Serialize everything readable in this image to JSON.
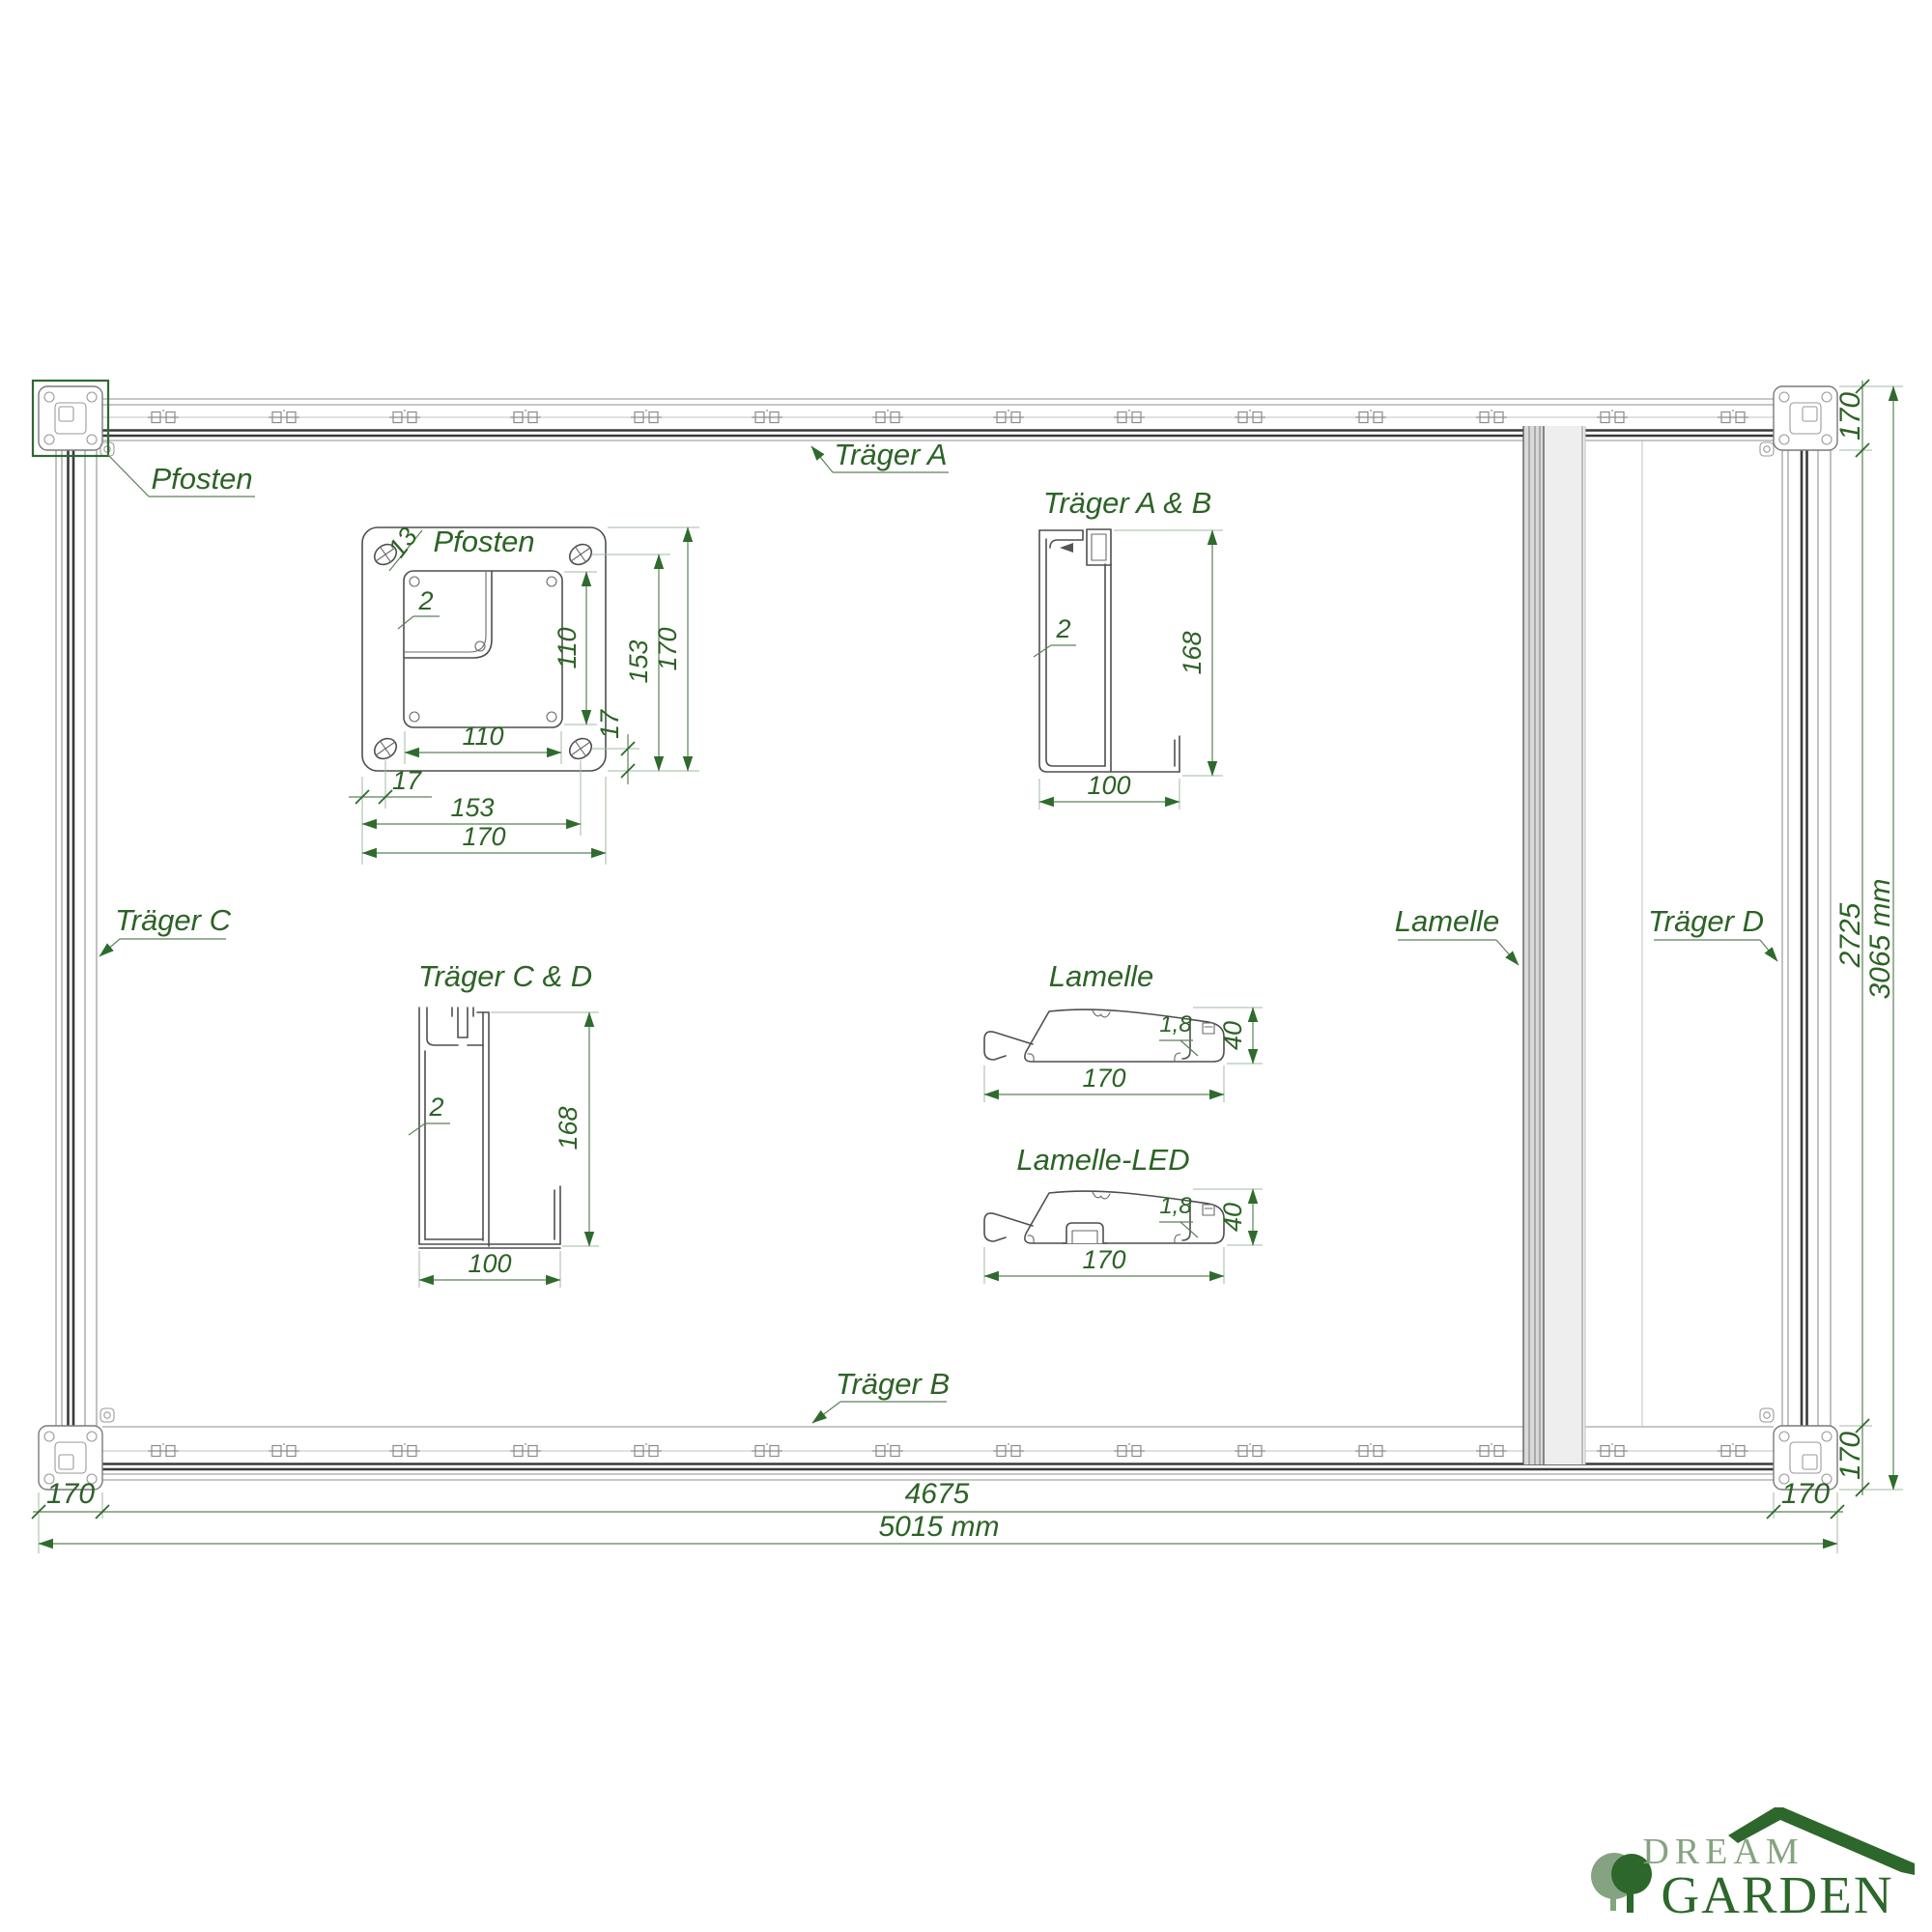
{
  "colors": {
    "dim_green": "#2c6325",
    "accent_green": "#2e6b2c",
    "logo_light_green": "#86a381",
    "logo_dark_green": "#2d672b",
    "line_gray": "#8f8f8f",
    "dark_line": "#3a3a3a"
  },
  "plan": {
    "labels": {
      "pfosten": "Pfosten",
      "traeger_a": "Träger A",
      "traeger_b": "Träger B",
      "traeger_c": "Träger C",
      "traeger_d": "Träger D",
      "lamelle": "Lamelle"
    },
    "dims": {
      "right_top_170": "170",
      "right_inner": "2725",
      "right_bottom_170": "170",
      "right_total": "3065 mm",
      "bottom_left_170": "170",
      "bottom_inner": "4675",
      "bottom_right_170": "170",
      "bottom_total": "5015 mm"
    }
  },
  "details": {
    "pfosten": {
      "title": "Pfosten",
      "hole_dia": "13",
      "wall": "2",
      "inner_height": "110",
      "bolt_offset_v": "153",
      "plate_height": "170",
      "edge_v": "17",
      "inner_width": "110",
      "edge_h": "17",
      "bolt_offset_h": "153",
      "plate_width": "170"
    },
    "traeger_ab": {
      "title": "Träger A & B",
      "wall": "2",
      "height": "168",
      "width": "100"
    },
    "traeger_cd": {
      "title": "Träger C & D",
      "wall": "2",
      "height": "168",
      "width": "100"
    },
    "lamelle": {
      "title": "Lamelle",
      "wall": "1,8",
      "height": "40",
      "width": "170"
    },
    "lamelle_led": {
      "title": "Lamelle-LED",
      "wall": "1,8",
      "height": "40",
      "width": "170"
    }
  },
  "logo": {
    "line1": "DREAM",
    "line2": "GARDEN"
  }
}
